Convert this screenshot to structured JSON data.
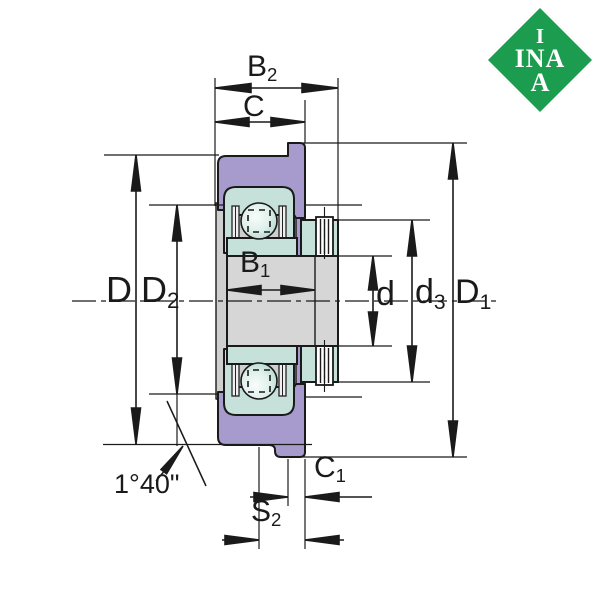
{
  "logo": {
    "line1": "I",
    "line2": "INA",
    "line3": "A"
  },
  "colors": {
    "housing_purple": "#a79bce",
    "bearing_teal": "#c6e0da",
    "bore_gray": "#d6d6d6",
    "cavity_gray": "#cfcfcf",
    "outline_black": "#1a1a1a",
    "logo_green": "#1b9c4e"
  },
  "dimensions": {
    "b2": {
      "main": "B",
      "sub": "2"
    },
    "c": {
      "main": "C",
      "sub": ""
    },
    "b1": {
      "main": "B",
      "sub": "1"
    },
    "d_outer": {
      "main": "D",
      "sub": ""
    },
    "d2": {
      "main": "D",
      "sub": "2"
    },
    "d_bore": {
      "main": "d",
      "sub": ""
    },
    "d3": {
      "main": "d",
      "sub": "3"
    },
    "d1": {
      "main": "D",
      "sub": "1"
    },
    "c1": {
      "main": "C",
      "sub": "1"
    },
    "s2": {
      "main": "S",
      "sub": "2"
    }
  },
  "annotations": {
    "misalignment_angle": "1°40\""
  }
}
